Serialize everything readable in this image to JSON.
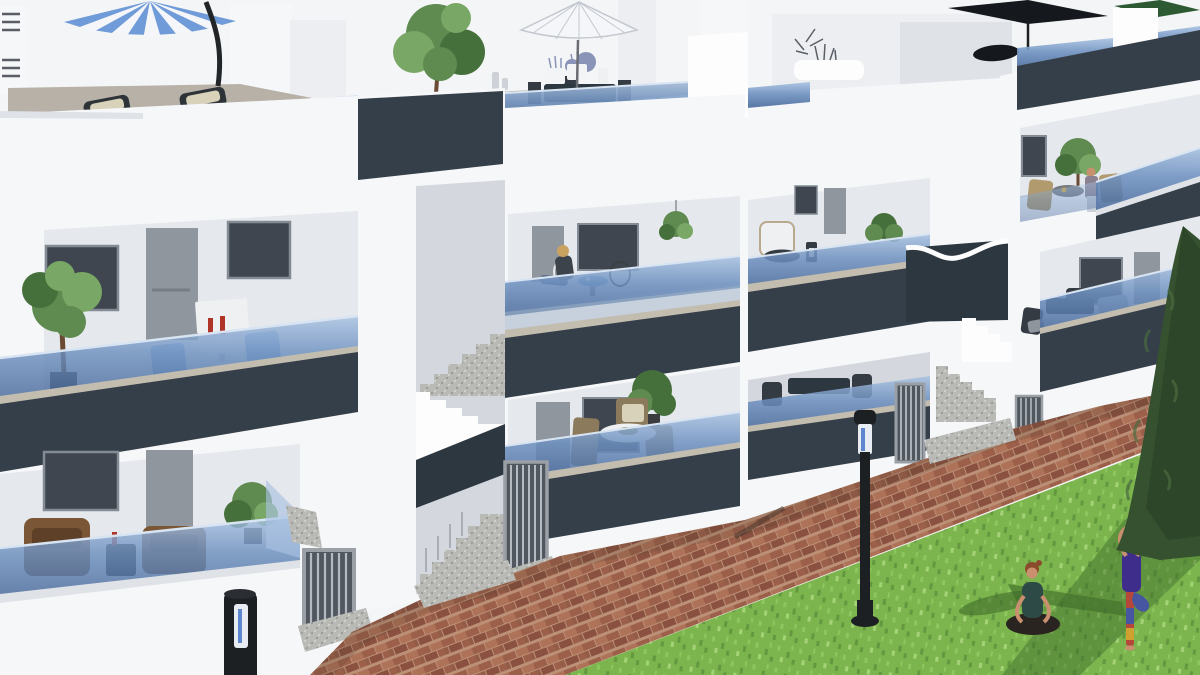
{
  "scene": {
    "title": "New-build apartment complex – 3D exterior render",
    "setting": "Three-storey white residential blocks with dark slate fascia bands, frameless blue glass balustrades, rooftop terraces, a brick-paved esplanade and a lawn",
    "elements": [
      {
        "name": "striped-parasol",
        "note": "blue/white striped cantilever parasol on left rooftop terrace"
      },
      {
        "name": "sun-loungers",
        "note": "two dark loungers with cream cushions behind rooftop glass"
      },
      {
        "name": "white-parasol",
        "note": "white parasol over rooftop dining table with flowers and planters"
      },
      {
        "name": "black-parasol",
        "note": "dark parasol on background rooftop, right"
      },
      {
        "name": "green-parasol",
        "note": "green cantilever parasol, top right corner"
      },
      {
        "name": "balcony-ficus-tree",
        "note": "potted ficus on wrap-around first-floor balcony, left"
      },
      {
        "name": "balcony-bistro-set",
        "note": "white table with red bottles and light-blue chairs"
      },
      {
        "name": "seated-woman-balcony",
        "note": "blonde woman seated at blue bistro table, middle balcony"
      },
      {
        "name": "dining-set-terrace",
        "note": "round table with wooden chairs and olive centerpiece, middle ground floor"
      },
      {
        "name": "wicker-lounge-set",
        "note": "rattan sofas on left ground-floor terrace"
      },
      {
        "name": "white-armchair-lantern",
        "note": "white armchair, dark round table and lantern on rear balcony"
      },
      {
        "name": "dark-dining-set",
        "note": "anthracite dining set on right block terrace"
      },
      {
        "name": "balcony-resident",
        "note": "figure standing beside small tree and table, right block top balcony"
      },
      {
        "name": "stairwells",
        "note": "two open granite stairs with white zig-zag stringers and slate walls"
      },
      {
        "name": "entrance-gates",
        "note": "light grey vertical-bar pedestrian gates at street level"
      },
      {
        "name": "bollard-lights",
        "note": "two black cylindrical path lights with clear lens band"
      },
      {
        "name": "brick-esplanade",
        "note": "reddish herringbone clay pavers along the facade"
      },
      {
        "name": "lawn",
        "note": "green lawn, bottom right"
      },
      {
        "name": "yoga-woman-seated",
        "note": "woman in dark teal top meditating cross-legged on grass"
      },
      {
        "name": "yoga-woman-standing",
        "note": "woman in purple tank and multicoloured leggings in tree pose"
      },
      {
        "name": "cypress-tree",
        "note": "tall dark conifer at right edge"
      }
    ]
  },
  "colors": {
    "sky": "#f4f5f6",
    "white_bright": "#fdfdfe",
    "white": "#f6f7f9",
    "white_shade": "#eceef1",
    "white_deep": "#dfe2e7",
    "interior": "#e5e8ec",
    "interior_shade": "#d4d8de",
    "slate": "#353f49",
    "slate_dark": "#2d3740",
    "glass_hi": "#a9c2e2",
    "glass_mid": "#6d90bf",
    "glass_deep": "#47689a",
    "glass_rim": "#d8e4f2",
    "cap_beige": "#c3bdb0",
    "deck": "#b7b1a7",
    "granite": "#b9bab6",
    "granite_dark": "#999a96",
    "granite_light": "#d4d5d1",
    "door": "#8f969e",
    "window": "#3f464f",
    "frame": "#848b94",
    "grout": "#bc8f77",
    "brick_a": "#9c604a",
    "brick_b": "#8a5140",
    "brick_c": "#ad7257",
    "brick_d": "#935c47",
    "grass": "#7cb54d",
    "grass_light": "#8cc75e",
    "grass_dark": "#649840",
    "grass_pale": "#a4d377",
    "tree": "#5f8a50",
    "tree_dark": "#46703b",
    "tree_light": "#79a765",
    "cypress": "#36512f",
    "cypress_dark": "#273d23",
    "cypress_light": "#4a6b3e",
    "wicker": "#7a5636",
    "wicker_dark": "#5e3f27",
    "cushion": "#d9d2ba",
    "wood": "#8c7a5c",
    "blue_chair": "#8fb3d9",
    "dark_furn": "#343b43",
    "table_white": "#eef0f2",
    "bottle_red": "#b03328",
    "olive": "#7a7a46",
    "lavender": "#8a93b8",
    "planter_white": "#f3f4f6",
    "umb_blue": "#6f9bd8",
    "umb_white": "#f4f6f9",
    "umb_rib": "#c3c8cf",
    "umb_black": "#15181c",
    "umb_green": "#2d5a33",
    "pole_black": "#222528",
    "lamp": "#1d2023",
    "lamp_glass": "#e8edf3",
    "lamp_glass_blue": "#3a6bc4",
    "metal": "#9aa0a6",
    "metal_light": "#b4bac0",
    "gate_shadow": "#50575f",
    "skin": "#c9906f",
    "hair_auburn": "#8a4a2c",
    "hair_blonde": "#c9a25f",
    "teal_top": "#2e4a46",
    "purple_top": "#3f2d8c",
    "legging_red": "#b5483a",
    "legging_blue": "#4656a0",
    "legging_yellow": "#d0a12e",
    "denim": "#5a6f8a",
    "pants_dark": "#2a2420",
    "shadow_grass": "#3f6a2c",
    "shadow_brick": "#3c2f28",
    "trunk": "#6b4a33",
    "pot_dark": "#3a3c3f",
    "vent_slat": "#5a5f66",
    "grey_box": "#70757c",
    "table_grey": "#757a80",
    "tan_chair": "#b09a6e"
  }
}
